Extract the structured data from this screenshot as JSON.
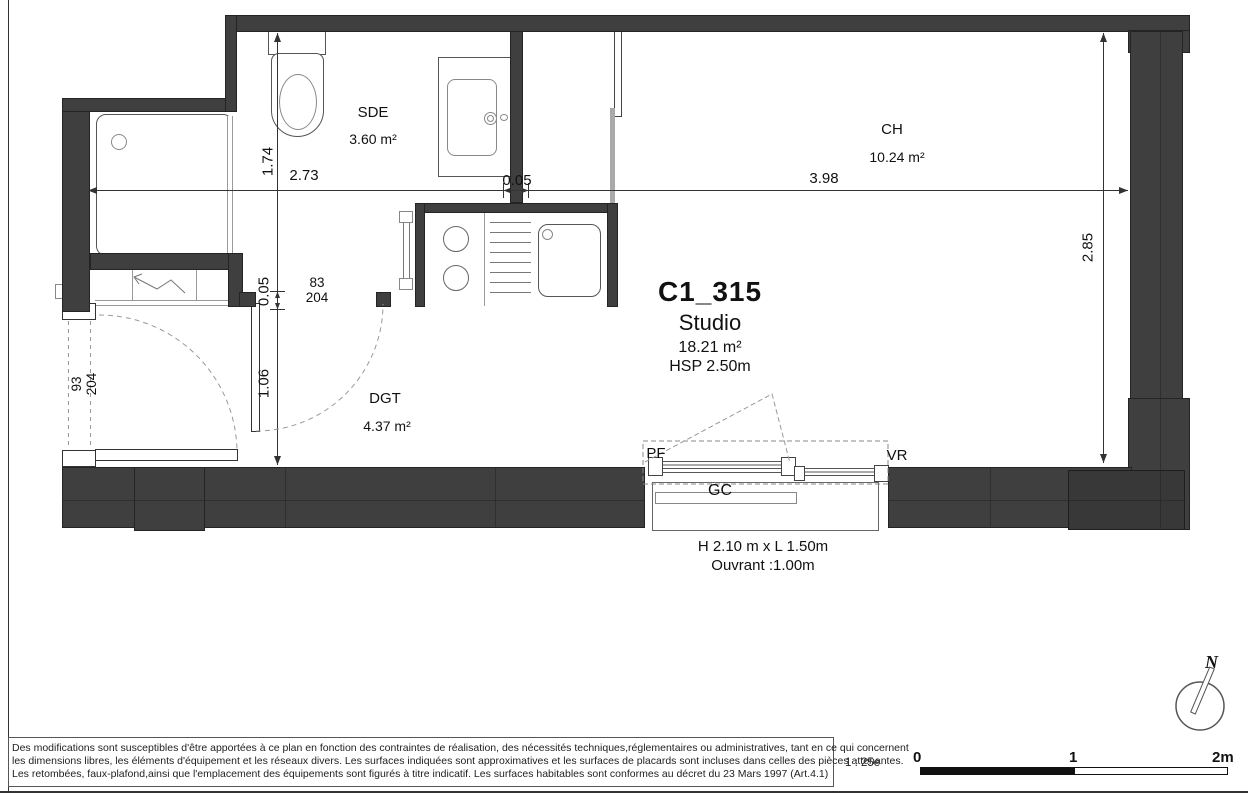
{
  "plan": {
    "unit_id": "C1_315",
    "unit_type": "Studio",
    "unit_area": "18.21 m²",
    "unit_height": "HSP 2.50m",
    "rooms": {
      "sde": {
        "name": "SDE",
        "area": "3.60 m²"
      },
      "ch": {
        "name": "CH",
        "area": "10.24 m²"
      },
      "dgt": {
        "name": "DGT",
        "area": "4.37 m²"
      }
    },
    "dimensions": {
      "width_sde": "2.73",
      "wall_gap_h": "0.05",
      "width_ch": "3.98",
      "height_sde": "1.74",
      "wall_gap_v": "0.05",
      "entry_depth": "1.06",
      "height_ch": "2.85",
      "door_interior_w": "83",
      "door_interior_h": "204",
      "door_entry_w": "93",
      "door_entry_h": "204"
    },
    "window": {
      "pf": "PF",
      "vr": "VR",
      "gc": "GC",
      "size": "H 2.10 m x  L 1.50m",
      "opening": "Ouvrant :1.00m"
    },
    "north_label": "N"
  },
  "footer": {
    "disclaimer": [
      "Des modifications sont susceptibles d'être apportées à ce plan en fonction des contraintes de réalisation, des nécessités techniques,réglementaires ou administratives, tant en ce qui concernent",
      "les dimensions libres, les éléments d'équipement et les réseaux divers. Les surfaces indiquées sont approximatives et les surfaces de placards sont incluses dans celles des pièces attenantes.",
      "Les retombées, faux-plafond,ainsi que l'emplacement des équipements sont figurés à titre indicatif. Les surfaces habitables sont conformes au décret du 23 Mars 1997 (Art.4.1)"
    ],
    "scale_label": "1 : 25e",
    "scale_ticks": [
      "0",
      "1",
      "2m"
    ]
  },
  "colors": {
    "wall": "#3f3f3f",
    "line": "#333333"
  }
}
